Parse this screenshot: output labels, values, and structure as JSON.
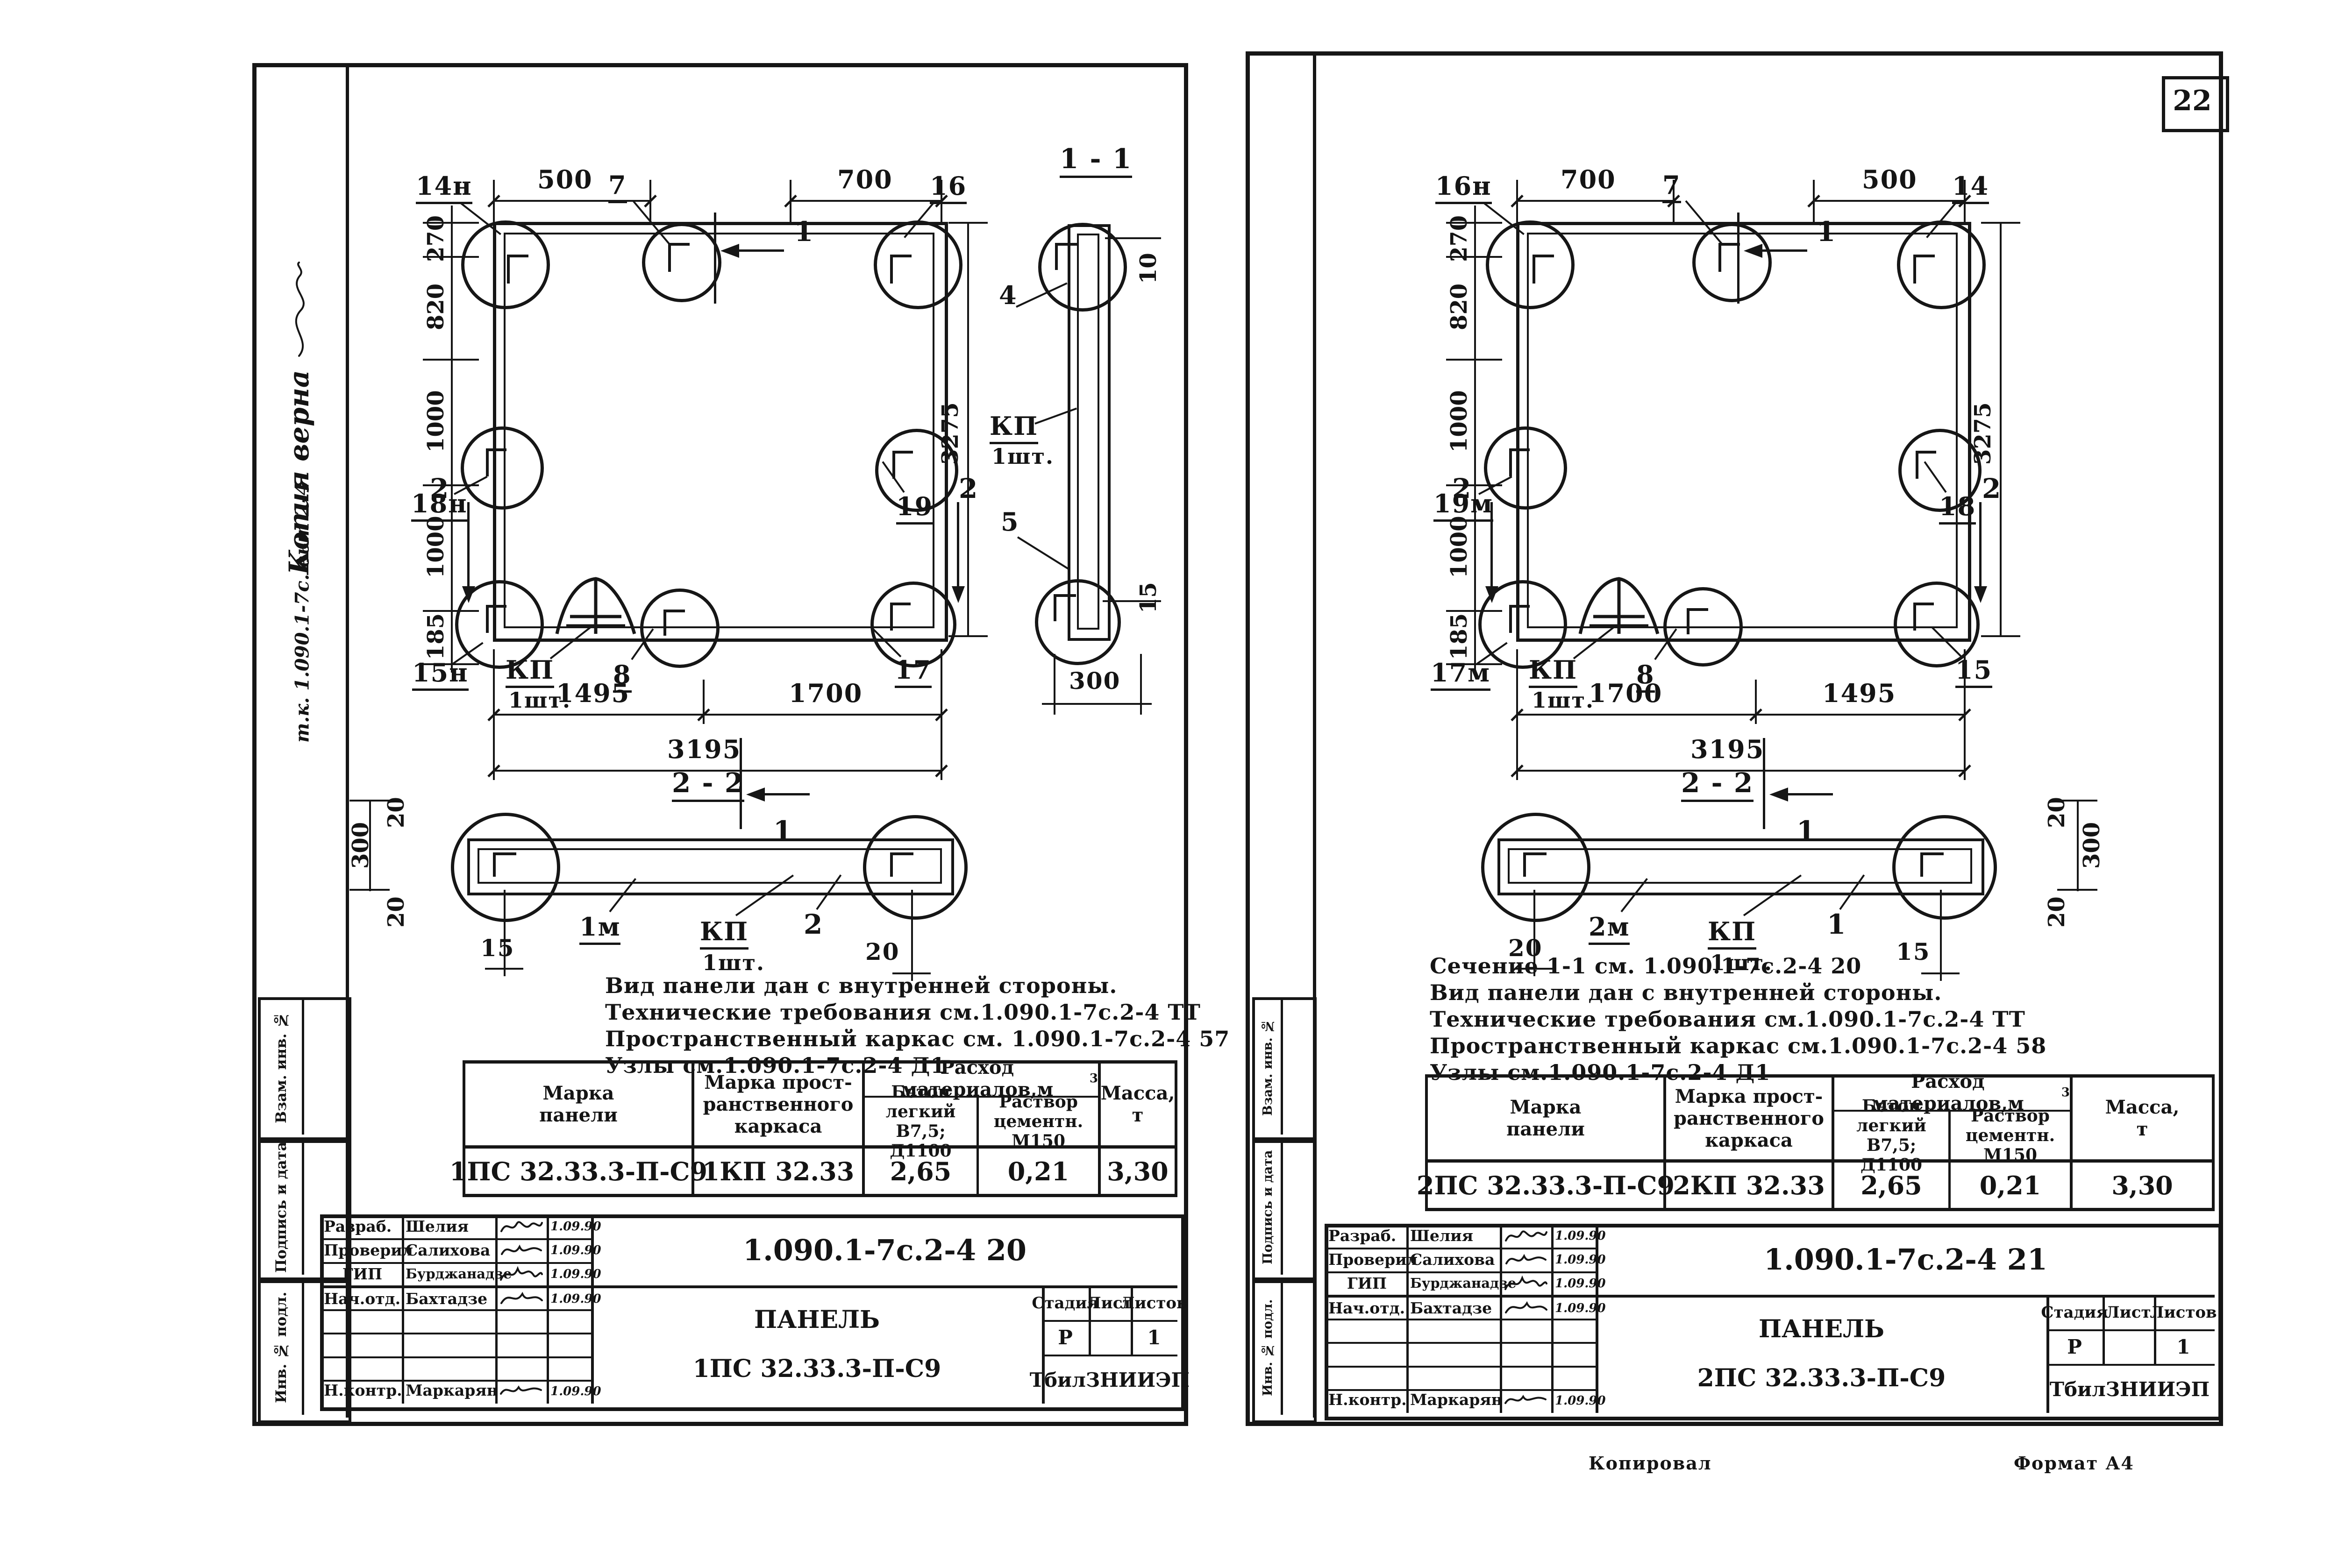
{
  "page": {
    "number": "22",
    "footer_copy": "Копировал",
    "footer_format": "Формат А4",
    "ink": "#161616",
    "paper": "#ffffff"
  },
  "margin": {
    "labels": {
      "vzam": "Взам. инв. №",
      "podp": "Подпись и дата",
      "inv": "Инв. № подл."
    },
    "hand_line1": "Копия верна",
    "hand_line2": "т.к. 1.090.1-7с. вып 2-4"
  },
  "left_sheet": {
    "elevation": {
      "dim_top_left": "500",
      "dim_top_right": "700",
      "dim_270": "270",
      "dim_820": "820",
      "dim_1000a": "1000",
      "dim_1000b": "1000",
      "dim_185": "185",
      "dim_height": "3275",
      "dim_bot_left": "1495",
      "dim_bot_right": "1700",
      "dim_total": "3195",
      "lbl_top_left": "14н",
      "lbl_top_center": "7",
      "lbl_top_right": "16",
      "lbl_mid_left": "18н",
      "lbl_mid_right": "19",
      "lbl_bot_left": "15н",
      "lbl_kp": "КП",
      "lbl_kp_qty": "1шт.",
      "lbl_bot_center": "8",
      "lbl_bot_right": "17",
      "sec_mark_h": "1",
      "sec_mark_v": "2"
    },
    "section11": {
      "title": "1 - 1",
      "lbl_top": "4",
      "lbl_kp": "КП",
      "lbl_kp_qty": "1шт.",
      "lbl_bot": "5",
      "dim_top": "10",
      "dim_bot": "15",
      "dim_width": "300"
    },
    "section22": {
      "title": "2 - 2",
      "dim_300": "300",
      "dim_20_top": "20",
      "dim_20_bot": "20",
      "dim_15": "15",
      "lbl_left": "1м",
      "lbl_kp": "КП",
      "lbl_kp_qty": "1шт.",
      "lbl_right": "2",
      "dim_20_right": "20"
    },
    "notes": [
      "Вид панели дан с внутренней стороны.",
      "Технические требования см.1.090.1-7с.2-4 ТТ",
      "Пространственный каркас см. 1.090.1-7с.2-4 57",
      "Узлы см.1.090.1-7с.2-4 Д1"
    ],
    "table": {
      "h_mark": "Марка\nпанели",
      "h_frame": "Марка прост-\nранственного\nкаркаса",
      "h_materials": "Расход материалов,м",
      "h_materials_sup": "3",
      "h_concrete": "Бетон\nлегкий\nВ7,5; Д1100",
      "h_mortar": "Раствор\nцементн.\nМ150",
      "h_mass": "Масса,\nт",
      "mark": "1ПС 32.33.3-П-С9",
      "frame": "1КП 32.33",
      "concrete": "2,65",
      "mortar": "0,21",
      "mass": "3,30"
    },
    "titleblock": {
      "doc": "1.090.1-7с.2-4 20",
      "rows": [
        {
          "role": "Разраб.",
          "name": "Шелия",
          "date": "1.09.90"
        },
        {
          "role": "Проверил",
          "name": "Салихова",
          "date": "1.09.90"
        },
        {
          "role": "ГИП",
          "name": "Бурджанадзе",
          "date": "1.09.90"
        },
        {
          "role": "Нач.отд.",
          "name": "Бахтадзе",
          "date": "1.09.90"
        },
        {
          "role": "Н.контр.",
          "name": "Маркарян",
          "date": "1.09.90"
        }
      ],
      "title_word": "ПАНЕЛЬ",
      "title_mark": "1ПС 32.33.3-П-С9",
      "h_stage": "Стадия",
      "h_sheet": "Лист",
      "h_sheets": "Листов",
      "stage": "Р",
      "sheets": "1",
      "org": "ТбилЗНИИЭП"
    }
  },
  "right_sheet": {
    "elevation": {
      "dim_top_left": "700",
      "dim_top_right": "500",
      "dim_270": "270",
      "dim_820": "820",
      "dim_1000a": "1000",
      "dim_1000b": "1000",
      "dim_185": "185",
      "dim_height": "3275",
      "dim_bot_left": "1700",
      "dim_bot_right": "1495",
      "dim_total": "3195",
      "lbl_top_left": "16н",
      "lbl_top_center": "7",
      "lbl_top_right": "14",
      "lbl_mid_left": "19м",
      "lbl_mid_right": "18",
      "lbl_bot_left": "17м",
      "lbl_kp": "КП",
      "lbl_kp_qty": "1шт.",
      "lbl_bot_center": "8",
      "lbl_bot_right": "15",
      "sec_mark_h": "1",
      "sec_mark_v": "2"
    },
    "section22": {
      "title": "2 - 2",
      "dim_300": "300",
      "dim_20_top": "20",
      "dim_20_bot": "20",
      "dim_20_left": "20",
      "lbl_left": "2м",
      "lbl_kp": "КП",
      "lbl_kp_qty": "1шт.",
      "lbl_right": "1",
      "dim_15": "15"
    },
    "notes": [
      "Сечение 1-1 см. 1.090.1-7с.2-4 20",
      "Вид панели дан с внутренней стороны.",
      "Технические требования см.1.090.1-7с.2-4 ТТ",
      "Пространственный каркас см.1.090.1-7с.2-4 58",
      "Узлы см.1.090.1-7с.2-4 Д1"
    ],
    "table": {
      "h_mark": "Марка\nпанели",
      "h_frame": "Марка прост-\nранственного\nкаркаса",
      "h_materials": "Расход материалов,м",
      "h_materials_sup": "3",
      "h_concrete": "Бетон\nлегкий\nВ7,5; Д1100",
      "h_mortar": "Раствор\nцементн.\nМ150",
      "h_mass": "Масса,\nт",
      "mark": "2ПС 32.33.3-П-С9",
      "frame": "2КП 32.33",
      "concrete": "2,65",
      "mortar": "0,21",
      "mass": "3,30"
    },
    "titleblock": {
      "doc": "1.090.1-7с.2-4 21",
      "rows": [
        {
          "role": "Разраб.",
          "name": "Шелия",
          "date": "1.09.90"
        },
        {
          "role": "Проверил",
          "name": "Салихова",
          "date": "1.09.90"
        },
        {
          "role": "ГИП",
          "name": "Бурджанадзе",
          "date": "1.09.90"
        },
        {
          "role": "Нач.отд.",
          "name": "Бахтадзе",
          "date": "1.09.90"
        },
        {
          "role": "Н.контр.",
          "name": "Маркарян",
          "date": "1.09.90"
        }
      ],
      "title_word": "ПАНЕЛЬ",
      "title_mark": "2ПС 32.33.3-П-С9",
      "h_stage": "Стадия",
      "h_sheet": "Лист",
      "h_sheets": "Листов",
      "stage": "Р",
      "sheets": "1",
      "org": "ТбилЗНИИЭП"
    }
  }
}
